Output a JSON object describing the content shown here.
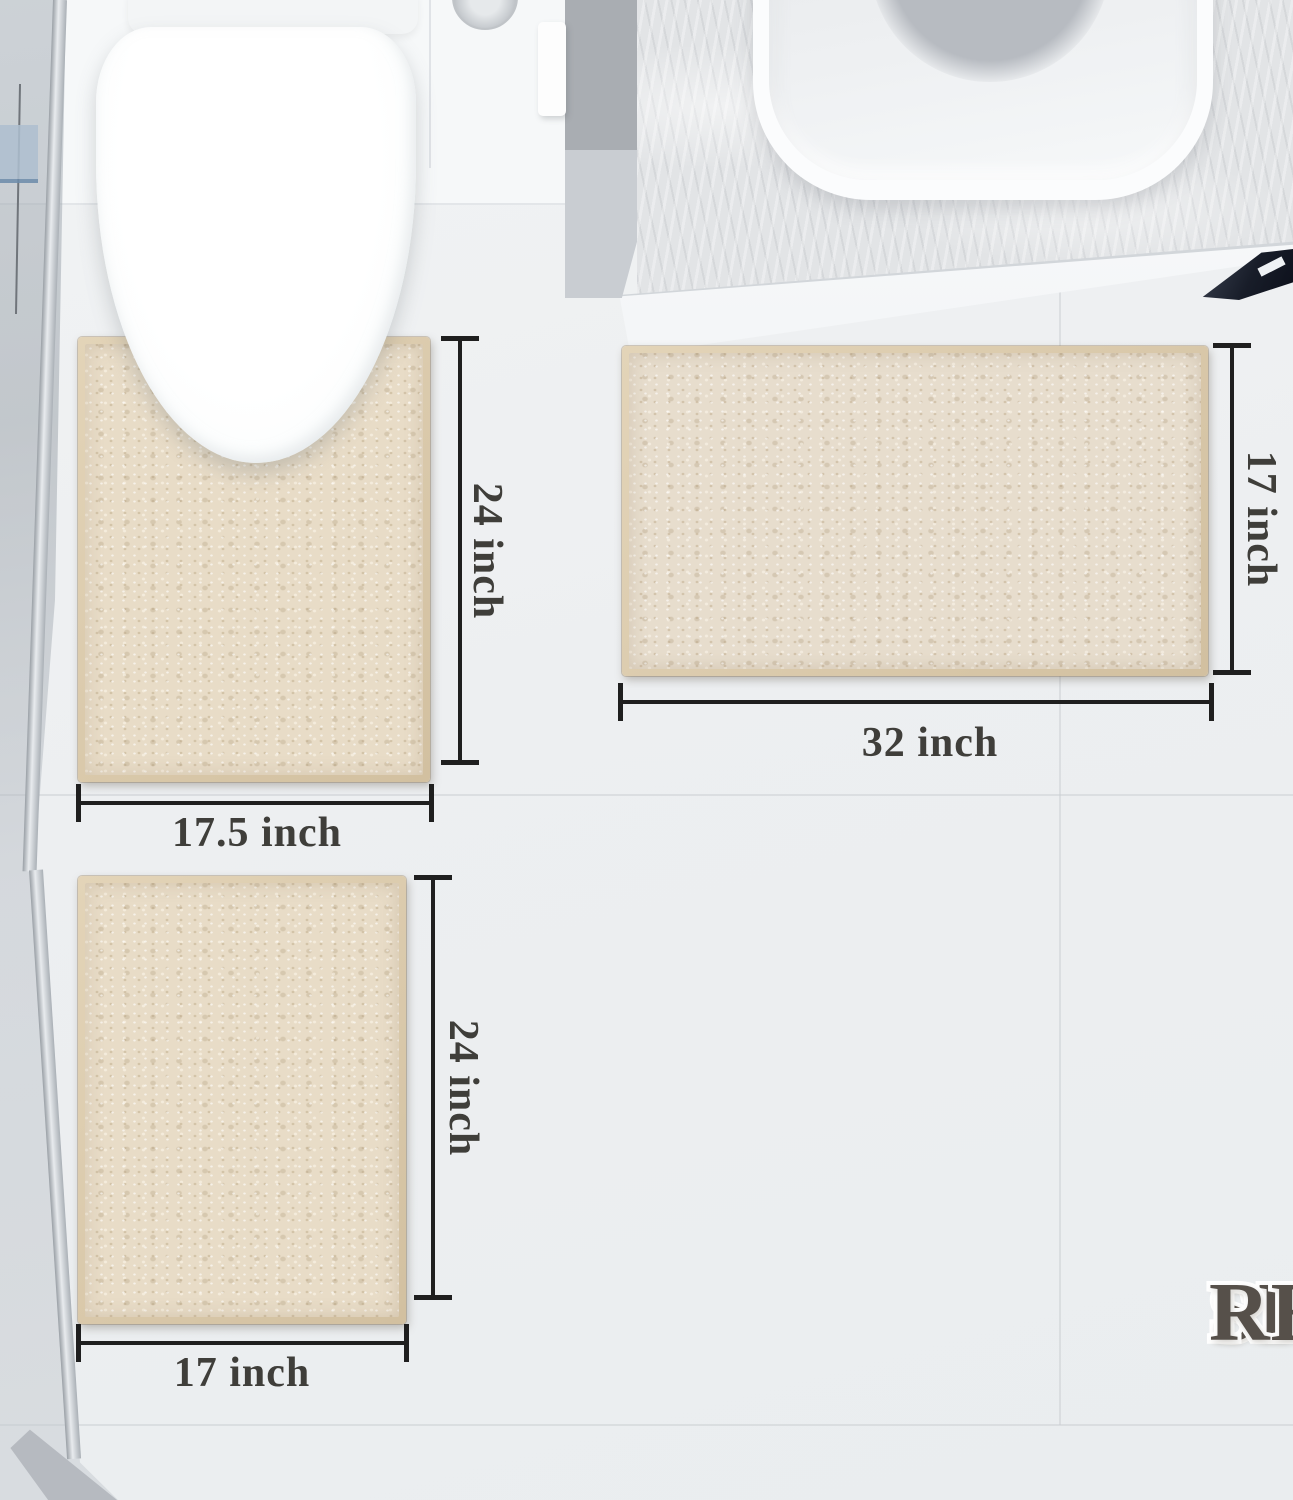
{
  "title": {
    "line1": "SIZE",
    "line2": "REFERENCE"
  },
  "dimensions": {
    "contour_mat": {
      "height": "24 inch",
      "width": "17.5 inch"
    },
    "runner_mat": {
      "height": "17 inch",
      "width": "32 inch"
    },
    "small_mat": {
      "height": "24 inch",
      "width": "17 inch"
    }
  },
  "colors": {
    "mat_fabric": "#e8dcc7",
    "mat_rim": "#d8c7aa",
    "dimension_line": "#1f1f1f",
    "dimension_text": "#3f3e3a",
    "title_text": "#56504a",
    "title_outline": "#ffffff",
    "floor": "#edeff1",
    "wall": "#f6f8f9",
    "counter_marble": "#e2e4e6",
    "rug_corner_navy": "#161b27"
  }
}
